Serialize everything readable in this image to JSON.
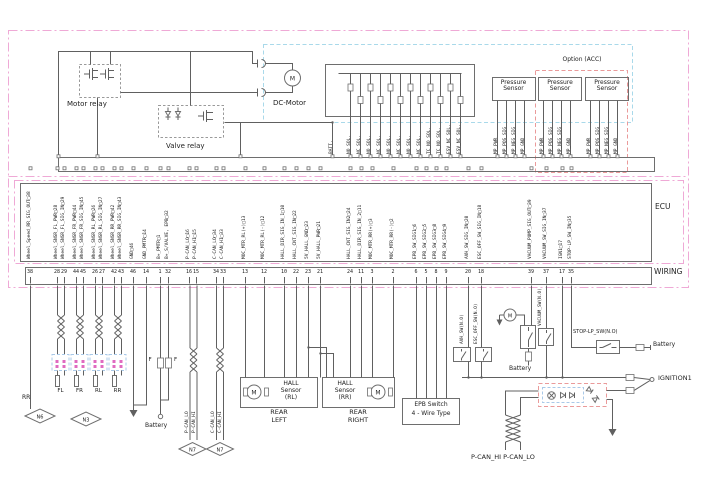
{
  "colors": {
    "pink_border": "#efa9d6",
    "cyan_border": "#a9d9ea",
    "red_border": "#ea9a9a",
    "blue_border": "#a9c9e8",
    "line": "#606060",
    "pink_dot": "#e06ac0"
  },
  "top_section": {
    "motor_relay_label": "Motor relay",
    "valve_relay_label": "Valve relay",
    "dc_motor_label": "DC-Motor",
    "motor_letter": "M",
    "option_acc_label": "Option (ACC)",
    "pressure_sensor_label": "Pressure Sensor",
    "solenoid_labels": [
      "BATT.",
      "NO SOL.",
      "NC SOL.",
      "NO SOL.",
      "NC SOL.",
      "NO SOL.",
      "NC SOL.",
      "NO SOL.",
      "NC SOL.",
      "TC_NO SOL.",
      "TC_NO SOL.",
      "ESV_NC SOL.",
      "ESV_NC SOL."
    ],
    "pressure_pin_labels": [
      "MP_PWR",
      "MP_POS_SIG",
      "MP_NEG_SIG",
      "MP_GND"
    ]
  },
  "ecu": {
    "label": "ECU",
    "pins": [
      {
        "name": "Wheel_Speed_RR_SIG_OUT",
        "pin": "38"
      },
      {
        "name": "Wheel_SNSR_FL_PWR",
        "pin": "28"
      },
      {
        "name": "Wheel_SNSR_FL_SIG_IN",
        "pin": "29"
      },
      {
        "name": "Wheel_SNSR_FR_PWR",
        "pin": "44"
      },
      {
        "name": "Wheel_SNSR_FR_SIG_IN",
        "pin": "45"
      },
      {
        "name": "Wheel_SNSR_RL_PWR",
        "pin": "26"
      },
      {
        "name": "Wheel_SNSR_RL_SIG_IN",
        "pin": "27"
      },
      {
        "name": "Wheel_SNSR_RR_PWR",
        "pin": "42"
      },
      {
        "name": "Wheel_SNSR_RR_SIG_IN",
        "pin": "43"
      },
      {
        "name": "GND",
        "pin": "46"
      },
      {
        "name": "GND_PMTR",
        "pin": "14"
      },
      {
        "name": "B+_PMTR",
        "pin": "1"
      },
      {
        "name": "B+_S/VALVE, EPB",
        "pin": "32"
      },
      {
        "name": "P-CAN_LO",
        "pin": "16"
      },
      {
        "name": "P-CAN_HI",
        "pin": "15"
      },
      {
        "name": "C-CAN_LO",
        "pin": "34"
      },
      {
        "name": "C-CAN_HI",
        "pin": "33"
      },
      {
        "name": "MOC_MTR_RL(+)",
        "pin": "13"
      },
      {
        "name": "MOC_MTR_RL(-)",
        "pin": "12"
      },
      {
        "name": "HALL_DIR_SIG_IN_1",
        "pin": "10"
      },
      {
        "name": "HALL_CNT_SIG_IN",
        "pin": "22"
      },
      {
        "name": "5V_HALL_GND",
        "pin": "23"
      },
      {
        "name": "5V_HALL_PWR",
        "pin": "21"
      },
      {
        "name": "HALL_CNT_SIG_IN2",
        "pin": "24"
      },
      {
        "name": "HALL_DIR_SIG_IN_2",
        "pin": "11"
      },
      {
        "name": "MOC_MTR_RR(+)",
        "pin": "3"
      },
      {
        "name": "MOC_MTR_RR(-)",
        "pin": "2"
      },
      {
        "name": "EPB_SW_SIG1",
        "pin": "6"
      },
      {
        "name": "EPB_SW_SIG2",
        "pin": "5"
      },
      {
        "name": "EPB_SW_SIG3",
        "pin": "8"
      },
      {
        "name": "EPB_SW_SIG4",
        "pin": "9"
      },
      {
        "name": "AVH_SW_SIG_IN",
        "pin": "20"
      },
      {
        "name": "ESC_OFF_SW_SIG_IN",
        "pin": "18"
      },
      {
        "name": "VACUUM_PUMP_SIG_OUT",
        "pin": "39"
      },
      {
        "name": "VACUUM_SW_SIG_IN",
        "pin": "37"
      },
      {
        "name": "IGN1",
        "pin": "17"
      },
      {
        "name": "STOP-LP_SW_IN",
        "pin": "35"
      }
    ]
  },
  "wiring": {
    "label": "WIRING"
  },
  "bottom": {
    "rr_stub_label": "RR",
    "connector_n6": "N6",
    "connector_n3": "N3",
    "connector_n7": "N7",
    "wheel_labels": [
      "FL",
      "FR",
      "RL",
      "RR"
    ],
    "fuse_label_left": "F",
    "fuse_label_right": "F",
    "battery_label": "Battery",
    "pcan_lo": "P-CAN_LO",
    "pcan_hi": "P-CAN_HI",
    "ccan_lo": "C-CAN_LO",
    "ccan_hi": "C-CAN_HI",
    "hall_rl_title": "HALL Sensor (RL)",
    "hall_rr_title": "HALL Sensor (RR)",
    "rear_left": "REAR LEFT",
    "rear_right": "REAR RIGHT",
    "epb_switch_title": "EPB Switch",
    "epb_switch_sub": "4 - Wire Type",
    "avh_sw_label": "AVH_SW(N.O)",
    "esc_off_sw_label": "ESC_OFF_SW(N.O)",
    "vacuum_sw_label": "VACUUM_SW(N.O)",
    "stop_lp_sw_label": "STOP-LP_SW(N.O)",
    "ignition_label": "IGNITION1",
    "pcan_pair_label": "P-CAN_HI  P-CAN_LO",
    "motor_letter": "M"
  }
}
